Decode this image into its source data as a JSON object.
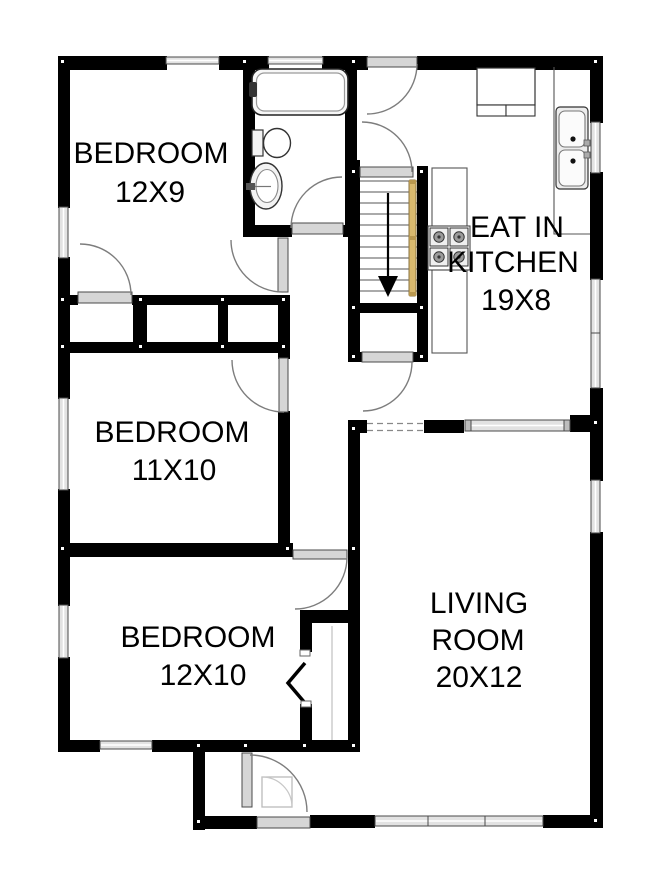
{
  "page": {
    "type": "floor-plan",
    "background": "#ffffff"
  },
  "rooms": {
    "bedroom_top": {
      "name": "BEDROOM",
      "size": "12X9"
    },
    "bedroom_middle": {
      "name": "BEDROOM",
      "size": "11X10"
    },
    "bedroom_bottom": {
      "name": "BEDROOM",
      "size": "12X10"
    },
    "living_room": {
      "name_line1": "LIVING",
      "name_line2": "ROOM",
      "size": "20X12"
    },
    "kitchen": {
      "name_line1": "EAT IN",
      "name_line2": "KITCHEN",
      "size": "19X8"
    }
  },
  "fixtures": [
    "bathtub",
    "toilet",
    "pedestal-sink",
    "double-kitchen-sink",
    "stove-cooktop",
    "upper-cabinet",
    "kitchen-counter",
    "staircase-down",
    "handrail",
    "closet-row",
    "bifold-closet-door",
    "front-door",
    "back-door"
  ],
  "colors": {
    "walls": "#000000",
    "door_panels": "#d6d6d6",
    "windows": "#e2e2e2",
    "handrail": "#d9b96e",
    "label_text": "#000000",
    "background": "#ffffff"
  }
}
